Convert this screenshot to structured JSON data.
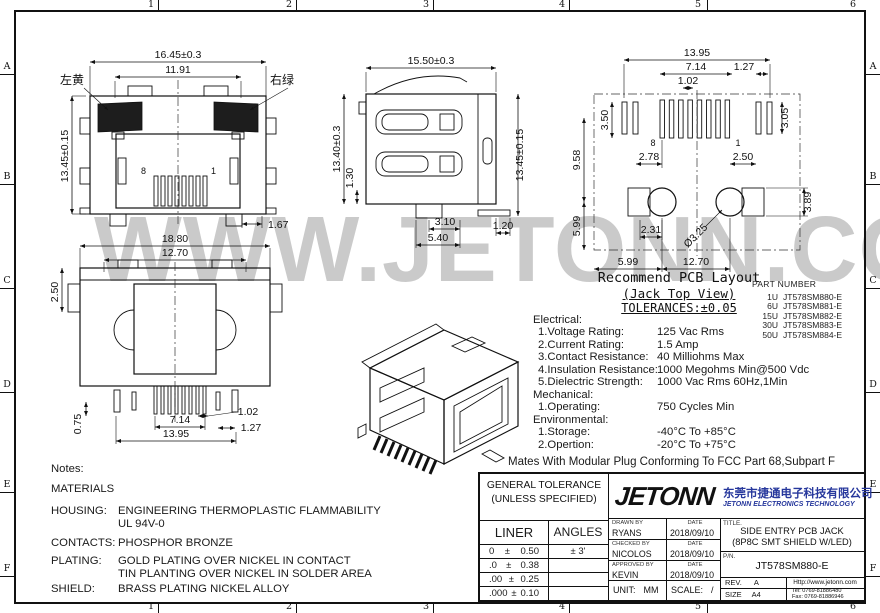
{
  "sheet": {
    "watermark": "WWW.JETONN.COM"
  },
  "frame": {
    "cols": [
      "1",
      "2",
      "3",
      "4",
      "5",
      "6"
    ],
    "rows": [
      "A",
      "B",
      "C",
      "D",
      "E",
      "F"
    ]
  },
  "views": {
    "front": {
      "dim_width_outer": "16.45±0.3",
      "dim_width_inner": "11.91",
      "dim_height": "13.45±0.15",
      "led_left": "左黄",
      "led_right": "右绿",
      "pin_left": "8",
      "pin_right": "1",
      "dim_foot": "1.67"
    },
    "side": {
      "dim_depth": "15.50±0.3",
      "dim_height_left": "13.40±0.3",
      "dim_step": "1.30",
      "dim_height_right": "13.45±0.15",
      "dim_tab": "3.10",
      "dim_tab_outer": "5.40",
      "dim_foot": "1.20"
    },
    "rear": {
      "dim_width_outer": "18.80",
      "dim_width_inner": "12.70",
      "dim_top": "2.50",
      "dim_pin": "0.75",
      "dim_span": "7.14",
      "dim_pitch": "1.02",
      "dim_edge": "1.27",
      "dim_row": "13.95"
    },
    "pcb": {
      "dim_row": "13.95",
      "dim_edge_pitch": "1.27",
      "dim_span": "7.14",
      "dim_pitch": "1.02",
      "dim_pad_left": "3.50",
      "dim_pad_right": "3.05",
      "dim_v_upper": "9.58",
      "dim_offset_left": "2.78",
      "dim_offset_right": "2.50",
      "dim_v_lower": "5.99",
      "dim_square": "2.31",
      "dim_square_h": "3.89",
      "dim_hole": "Ø3.25",
      "dim_edge_left": "5.99",
      "dim_hole_span": "12.70",
      "pin_left": "8",
      "pin_right": "1"
    }
  },
  "pcb_caption": {
    "line1": "Recommend PCB Layout",
    "line2": "(Jack Top View)",
    "line3": "TOLERANCES:±0.05"
  },
  "part_table": {
    "header": "PART NUMBER",
    "rows": [
      {
        "qty": "1U",
        "pn": "JT578SM880-E"
      },
      {
        "qty": "6U",
        "pn": "JT578SM881-E"
      },
      {
        "qty": "15U",
        "pn": "JT578SM882-E"
      },
      {
        "qty": "30U",
        "pn": "JT578SM883-E"
      },
      {
        "qty": "50U",
        "pn": "JT578SM884-E"
      }
    ]
  },
  "specs": {
    "electrical": "Electrical:",
    "rows_e": [
      {
        "label": "1.Voltage Rating:",
        "value": "125 Vac Rms"
      },
      {
        "label": "2.Current Rating:",
        "value": "1.5 Amp"
      },
      {
        "label": "3.Contact Resistance:",
        "value": "40 Milliohms Max"
      },
      {
        "label": "4.Insulation Resistance:",
        "value": "1000 Megohms Min@500 Vdc"
      },
      {
        "label": "5.Dielectric Strength:",
        "value": "1000 Vac Rms 60Hz,1Min"
      }
    ],
    "mechanical": "Mechanical:",
    "rows_m": [
      {
        "label": "1.Operating:",
        "value": "750 Cycles Min"
      }
    ],
    "environmental": "Environmental:",
    "rows_v": [
      {
        "label": "1.Storage:",
        "value": "-40°C To +85°C"
      },
      {
        "label": "2.Opertion:",
        "value": "-20°C To +75°C"
      }
    ],
    "footnote": "Mates With Modular Plug Conforming To FCC Part 68,Subpart F"
  },
  "notes": {
    "title": "Notes:",
    "materials": "MATERIALS",
    "rows": [
      {
        "label": "HOUSING:",
        "line1": "ENGINEERING THERMOPLASTIC FLAMMABILITY",
        "line2": "UL 94V-0"
      },
      {
        "label": "CONTACTS:",
        "line1": "PHOSPHOR BRONZE",
        "line2": ""
      },
      {
        "label": "PLATING:",
        "line1": "GOLD PLATING OVER NICKEL IN CONTACT",
        "line2": "TIN PLANTING OVER NICKEL IN SOLDER AREA"
      },
      {
        "label": "SHIELD:",
        "line1": "BRASS PLATING NICKEL ALLOY",
        "line2": ""
      }
    ]
  },
  "title_block": {
    "general_tolerance_1": "GENERAL TOLERANCE",
    "general_tolerance_2": "(UNLESS SPECIFIED)",
    "liner": "LINER",
    "angles": "ANGLES",
    "tol_rows": [
      {
        "prefix": "0",
        "pm": "±",
        "value": "0.50",
        "angle": "± 3'"
      },
      {
        "prefix": ".0",
        "pm": "±",
        "value": "0.38",
        "angle": ""
      },
      {
        "prefix": ".00",
        "pm": "±",
        "value": "0.25",
        "angle": ""
      },
      {
        "prefix": ".000",
        "pm": "±",
        "value": "0.10",
        "angle": ""
      }
    ],
    "logo": "JETONN",
    "company_cn": "东莞市捷通电子科技有限公司",
    "company_en": "JETONN ELECTRONICS TECHNOLOGY",
    "drawn_label": "DRAWN BY",
    "drawn": "RYANS",
    "drawn_date": "2018/09/10",
    "checked_label": "CHECKED BY",
    "checked": "NICOLOS",
    "checked_date": "2018/09/10",
    "approved_label": "APPROVED BY",
    "approved": "KEVIN",
    "approved_date": "2018/09/10",
    "date_label": "DATE",
    "unit_label": "UNIT:",
    "unit": "MM",
    "scale_label": "SCALE:",
    "scale": "/",
    "title_label": "TITLE.",
    "title_1": "SIDE ENTRY PCB JACK",
    "title_2": "(8P8C SMT SHIELD W/LED)",
    "pn_label": "P/N.",
    "pn": "JT578SM880-E",
    "rev_label": "REV.",
    "rev": "A",
    "size_label": "SIZE",
    "size": "A4",
    "website": "Http://www.jetonn.com",
    "tel": "Tel: 0769-81886480",
    "fax": "Fax: 0769-81886946"
  },
  "colors": {
    "line": "#1a1a1a",
    "watermark": "#cacaca",
    "brand": "#26379c",
    "paper": "#ffffff"
  }
}
